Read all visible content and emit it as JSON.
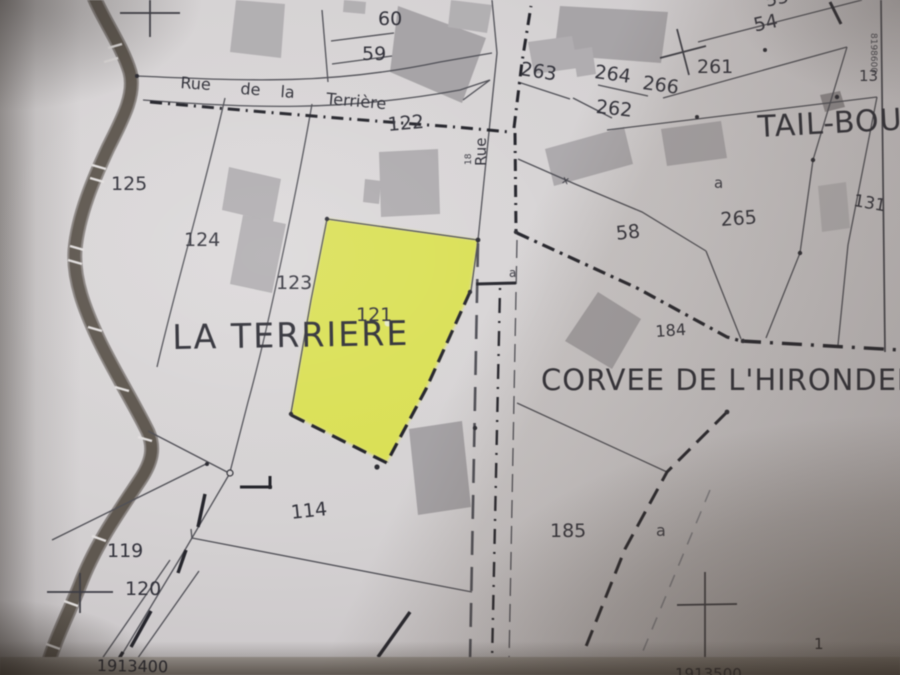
{
  "colors": {
    "paper": "#d7d3d4",
    "ink": "#3a3a42",
    "highlight_yellow": "#dce24b",
    "building_gray": "#b1aeb1",
    "band_dark": "#5b544d"
  },
  "localities": {
    "la_terriere": "LA TERRIERE",
    "corvee": "CORVEE DE L'HIRONDEL",
    "tail_boui": "TAIL-BOUI"
  },
  "grid": {
    "coord_bottom_left": "1913400",
    "coord_bottom_right": "1913500",
    "coord_right_vertical": "8198600",
    "scale_fragment": "1"
  },
  "labels": [
    {
      "text": "60",
      "x": 378,
      "y": 10,
      "size": 19
    },
    {
      "text": "59",
      "x": 362,
      "y": 45,
      "size": 19
    },
    {
      "text": "263",
      "x": 522,
      "y": 60,
      "size": 19,
      "rot": 9
    },
    {
      "text": "264",
      "x": 596,
      "y": 63,
      "size": 19,
      "rot": 8
    },
    {
      "text": "266",
      "x": 644,
      "y": 74,
      "size": 19,
      "rot": 8
    },
    {
      "text": "262",
      "x": 597,
      "y": 98,
      "size": 19,
      "rot": 6
    },
    {
      "text": "261",
      "x": 697,
      "y": 58,
      "size": 19
    },
    {
      "text": "54",
      "x": 752,
      "y": 17,
      "size": 19,
      "rot": -12
    },
    {
      "text": "53",
      "x": 764,
      "y": -7,
      "size": 18,
      "rot": -12
    },
    {
      "text": "13",
      "x": 859,
      "y": 69,
      "size": 15
    },
    {
      "text": "122",
      "x": 387,
      "y": 116,
      "size": 19,
      "rot": -5
    },
    {
      "text": "125",
      "x": 111,
      "y": 175,
      "size": 19
    },
    {
      "text": "124",
      "x": 184,
      "y": 231,
      "size": 19
    },
    {
      "text": "123",
      "x": 276,
      "y": 274,
      "size": 19
    },
    {
      "text": "121",
      "x": 356,
      "y": 306,
      "size": 19
    },
    {
      "text": "58",
      "x": 615,
      "y": 225,
      "size": 19,
      "rot": -6
    },
    {
      "text": "a",
      "x": 714,
      "y": 176,
      "size": 15,
      "cls": "sub",
      "name": "subdivision-letter"
    },
    {
      "text": "265",
      "x": 720,
      "y": 211,
      "size": 19,
      "rot": -4
    },
    {
      "text": "131",
      "x": 855,
      "y": 193,
      "size": 17,
      "rot": 10
    },
    {
      "text": "184",
      "x": 655,
      "y": 324,
      "size": 16,
      "rot": -4
    },
    {
      "text": "a",
      "x": 509,
      "y": 267,
      "size": 12,
      "cls": "sub",
      "name": "subdivision-letter"
    },
    {
      "text": "114",
      "x": 290,
      "y": 504,
      "size": 19,
      "rot": -6
    },
    {
      "text": "119",
      "x": 107,
      "y": 542,
      "size": 19
    },
    {
      "text": "120",
      "x": 125,
      "y": 580,
      "size": 19
    },
    {
      "text": "185",
      "x": 550,
      "y": 522,
      "size": 19
    },
    {
      "text": "a",
      "x": 656,
      "y": 523,
      "size": 16,
      "cls": "sub",
      "name": "subdivision-letter"
    },
    {
      "text": "x",
      "x": 564,
      "y": 174,
      "size": 11,
      "rot": 15,
      "cls": "sub",
      "name": "boundary-x-marker"
    },
    {
      "text": "18",
      "x": 465,
      "y": 165,
      "size": 9,
      "rot": -90,
      "cls": "sub",
      "name": "width-annotation"
    },
    {
      "text": "Rue",
      "x": 181,
      "y": 75,
      "size": 16,
      "rot": 4,
      "name": "street-label"
    },
    {
      "text": "de",
      "x": 241,
      "y": 81,
      "size": 16,
      "rot": 4,
      "name": "street-label"
    },
    {
      "text": "la",
      "x": 281,
      "y": 84,
      "size": 16,
      "rot": 4,
      "name": "street-label"
    },
    {
      "text": "Terrière",
      "x": 327,
      "y": 91,
      "size": 16,
      "rot": 5,
      "name": "street-label"
    },
    {
      "text": "Rue",
      "x": 474,
      "y": 166,
      "size": 15,
      "rot": -90,
      "name": "street-label"
    }
  ]
}
